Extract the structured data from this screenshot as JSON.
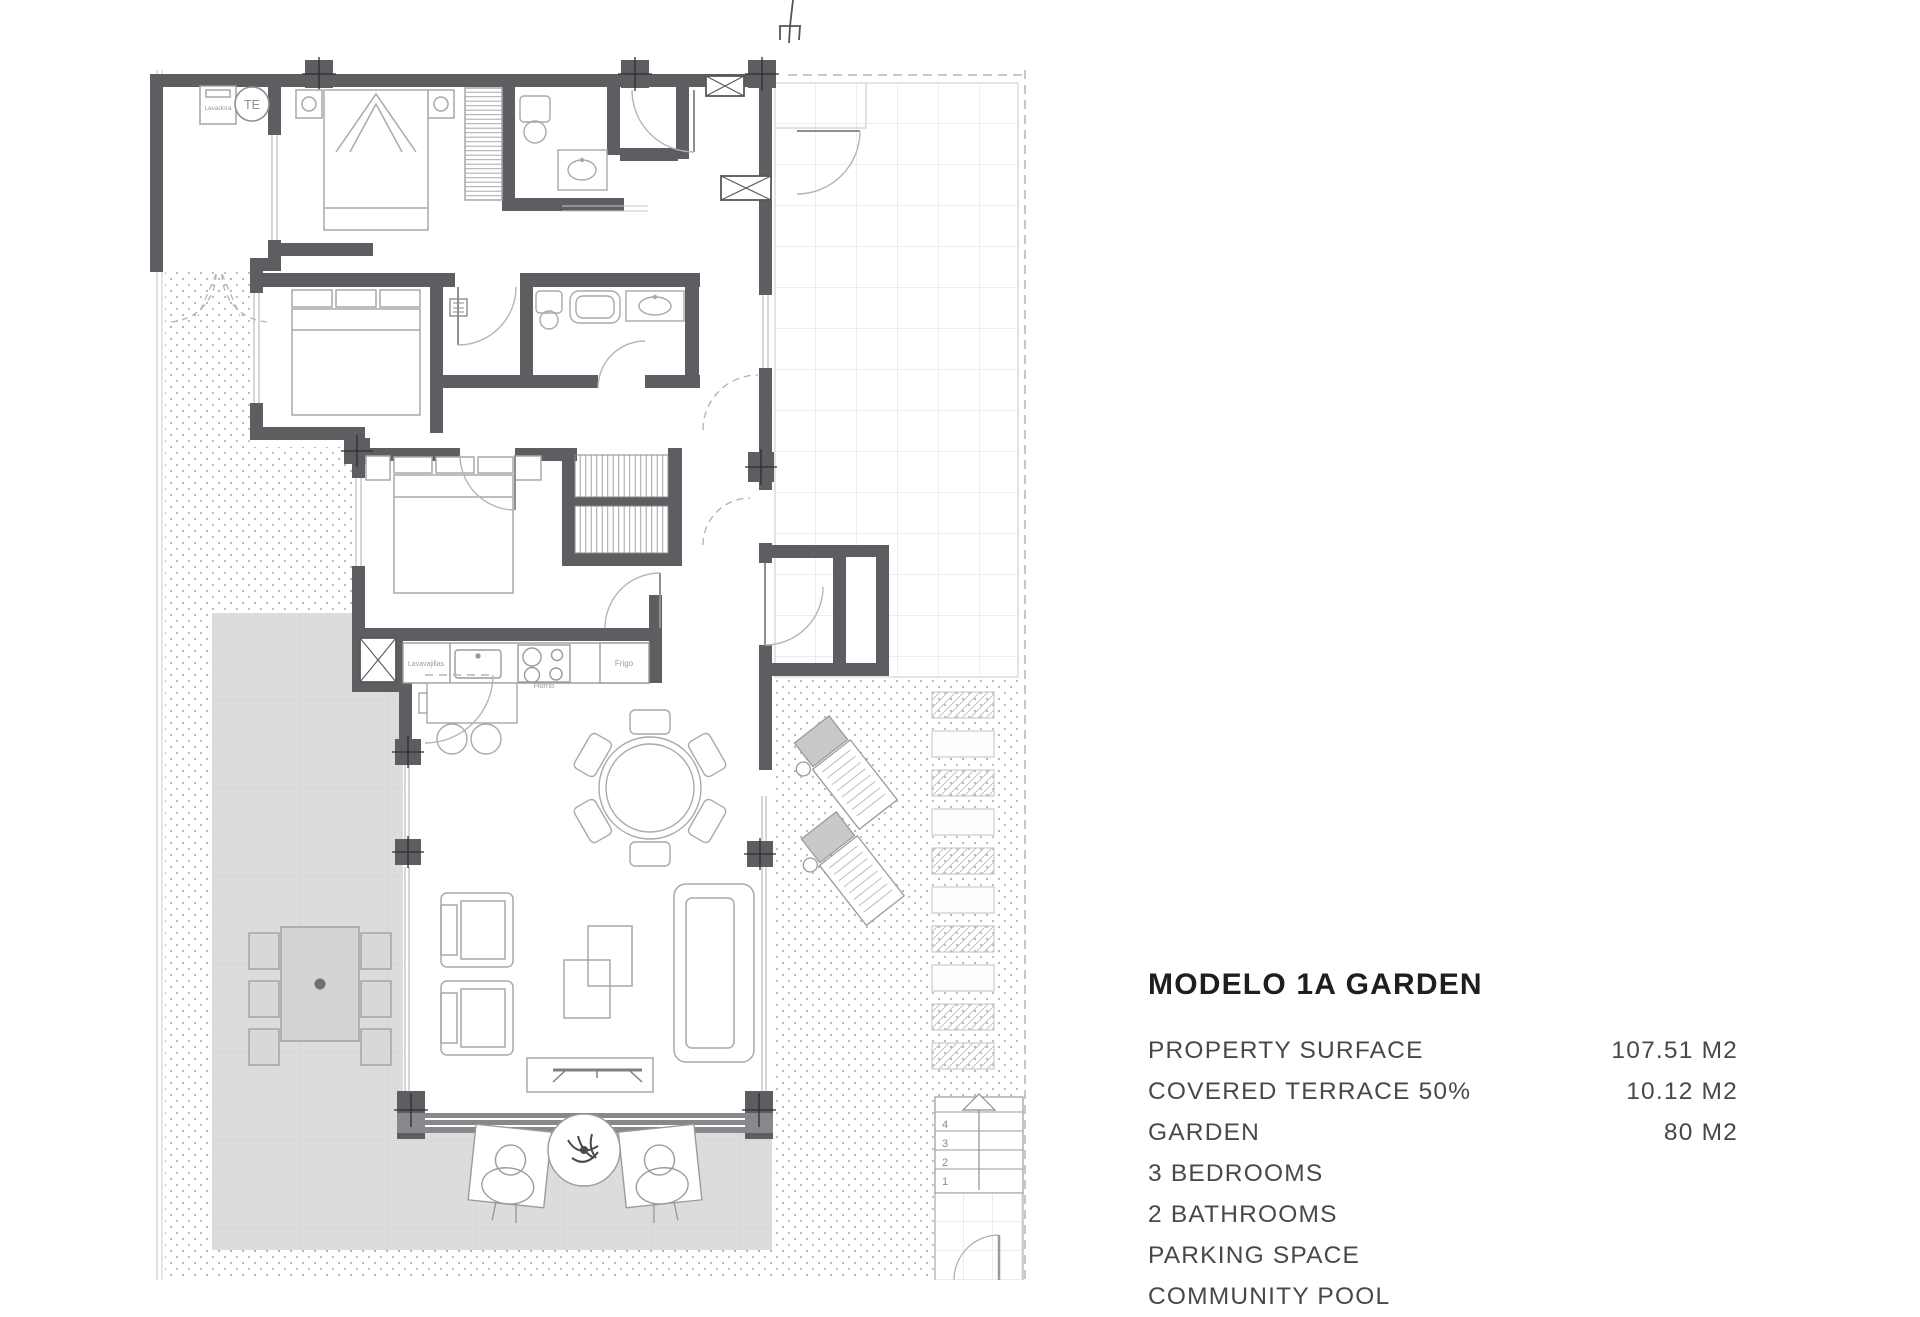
{
  "panel": {
    "title": "MODELO 1A GARDEN",
    "rows": [
      {
        "label": "PROPERTY SURFACE",
        "value": "107.51 M2"
      },
      {
        "label": "COVERED TERRACE 50%",
        "value": "10.12 M2"
      },
      {
        "label": "GARDEN",
        "value": "80 M2"
      },
      {
        "label": "3 BEDROOMS",
        "value": ""
      },
      {
        "label": "2 BATHROOMS",
        "value": ""
      },
      {
        "label": "PARKING SPACE",
        "value": ""
      },
      {
        "label": "COMMUNITY POOL",
        "value": ""
      }
    ]
  },
  "plan": {
    "labels": {
      "washer": "Lavadora",
      "water_heater": "TE",
      "dishwasher": "Lavavajillas",
      "oven": "Horno",
      "fridge": "Frigo"
    },
    "stair_numbers": [
      "4",
      "3",
      "2",
      "1"
    ]
  }
}
